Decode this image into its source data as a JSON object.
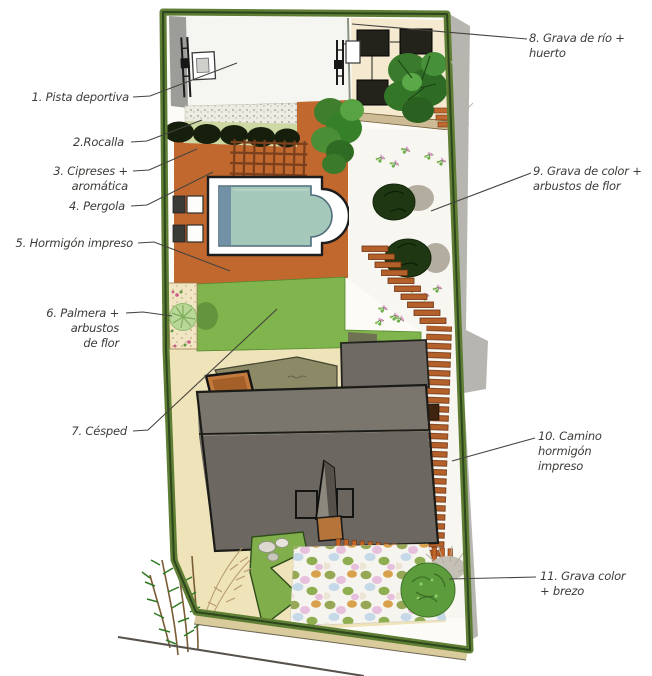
{
  "plan": {
    "annotations": [
      {
        "id": "1",
        "text": "1. Pista deportiva",
        "feature": "sports-court"
      },
      {
        "id": "2",
        "text": "2.Rocalla",
        "feature": "rockery"
      },
      {
        "id": "3",
        "text": "3. Cipreses + aromática",
        "feature": "cypress-row"
      },
      {
        "id": "4",
        "text": "4. Pergola",
        "feature": "pergola"
      },
      {
        "id": "5",
        "text": "5. Hormigón impreso",
        "feature": "stamped-concrete"
      },
      {
        "id": "6",
        "text": "6. Palmera + arbustos\nde flor",
        "feature": "palm-and-flower-shrubs"
      },
      {
        "id": "7",
        "text": "7. Césped",
        "feature": "lawn"
      },
      {
        "id": "8",
        "text": "8. Grava de río + huerto",
        "feature": "river-gravel-vegetable-garden"
      },
      {
        "id": "9",
        "text": "9. Grava de color +\narbustos de flor",
        "feature": "colored-gravel-flower-shrubs"
      },
      {
        "id": "10",
        "text": "10. Camino hormigón\nimpreso",
        "feature": "stamped-concrete-path"
      },
      {
        "id": "11",
        "text": "11. Grava color\n+ brezo",
        "feature": "colored-gravel-heather"
      }
    ],
    "palette": {
      "stamped_concrete": "#c1682f",
      "lawn": "#80b44d",
      "hedge": "#5e7e34",
      "pool_water": "#a4c9bb",
      "roof_grey": "#6c6761",
      "cream_path": "#efe3ba",
      "white_gravel": "#f7f6f1",
      "sleeper_wood": "#b4602a",
      "pebbles": [
        "#96a855",
        "#e7c0dc",
        "#c5d9e8",
        "#d9a14c",
        "#ece4d4"
      ]
    }
  }
}
